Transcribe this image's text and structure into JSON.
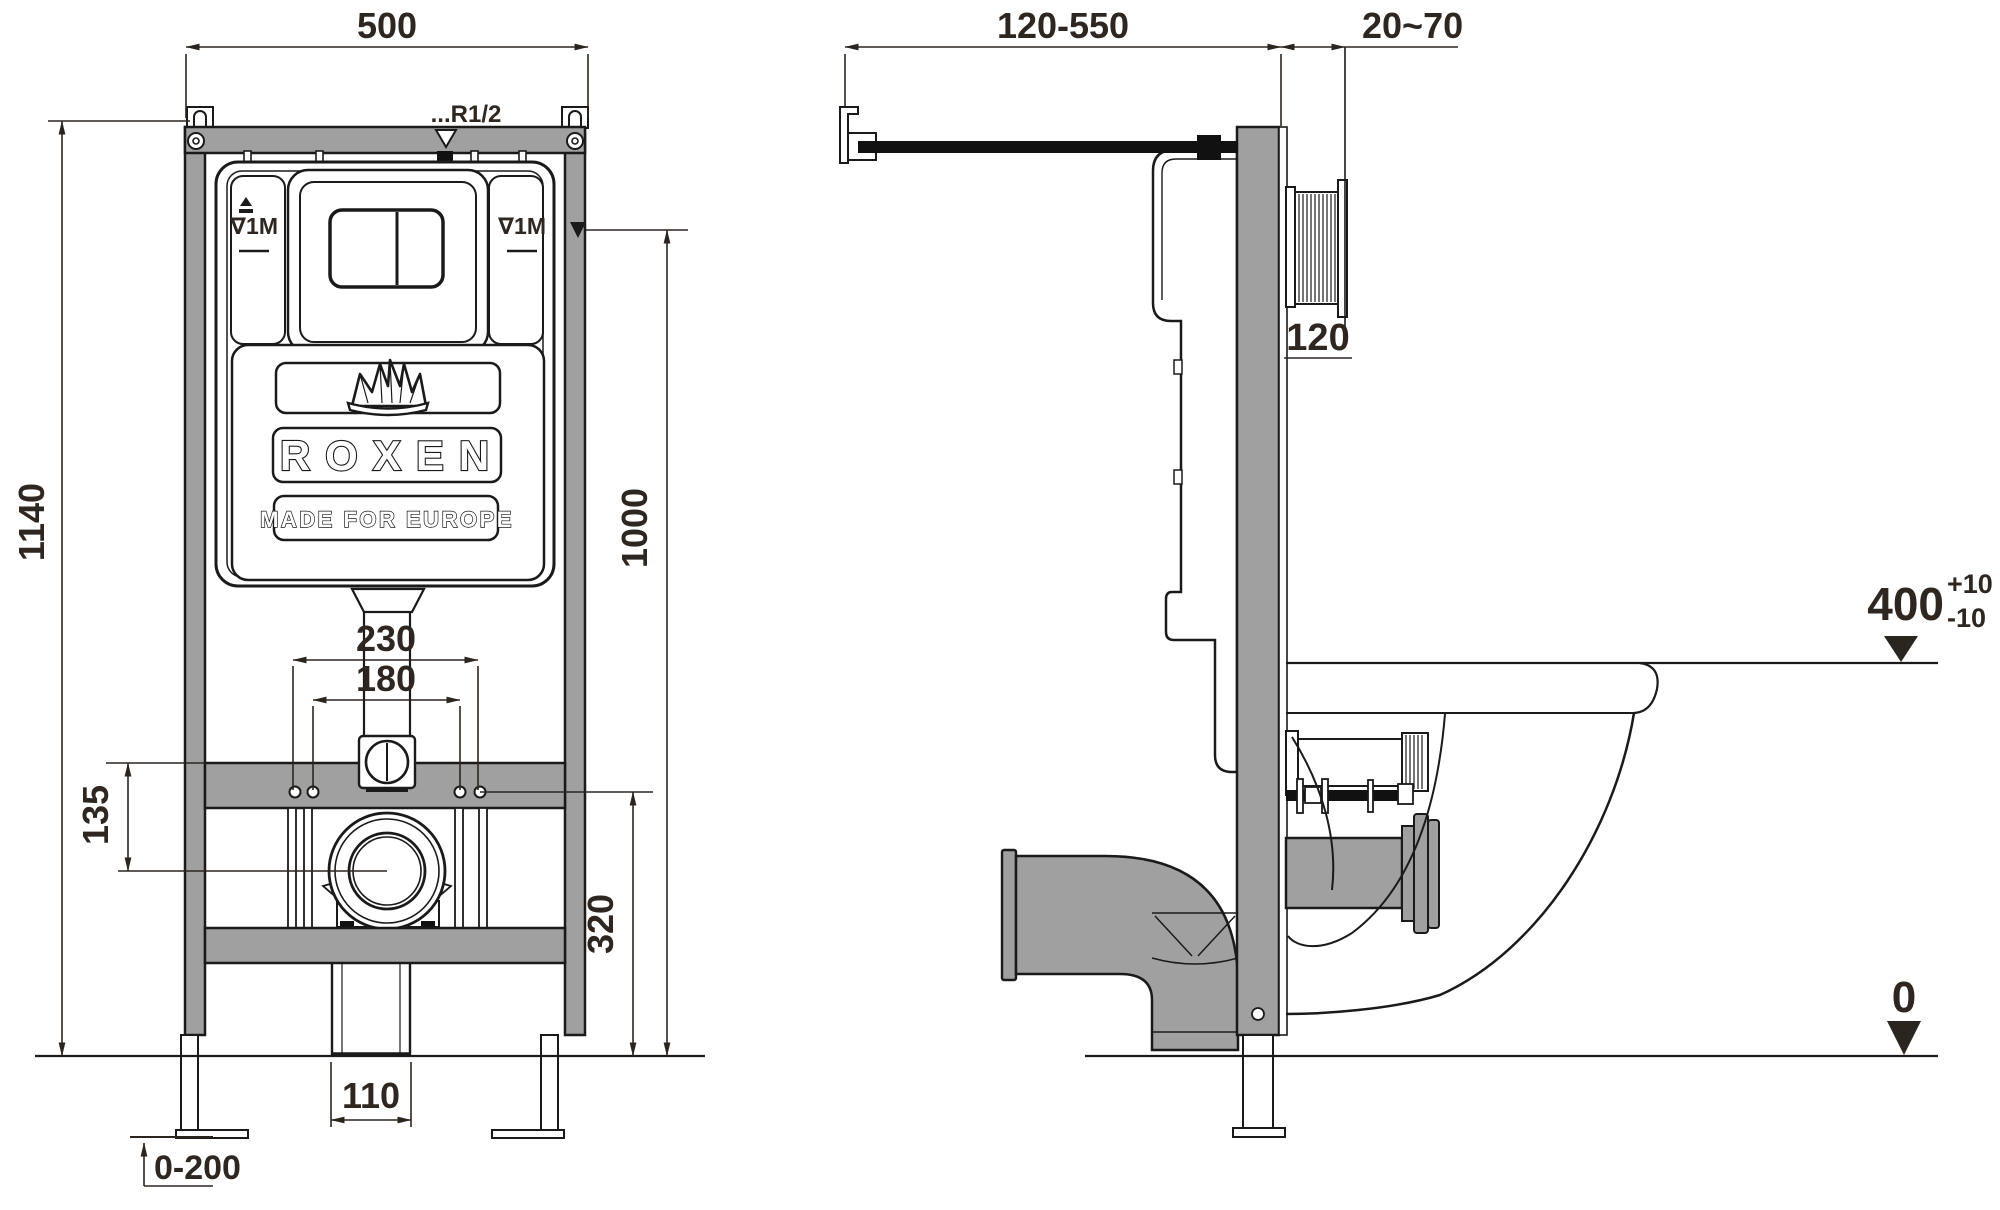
{
  "drawing": {
    "brand": {
      "name": "ROXEN",
      "tagline": "MADE FOR EUROPE",
      "logo_icon": "crown-icon"
    },
    "colors": {
      "metal_gray": "#a0a0a0",
      "line_black": "#1a1a1a",
      "dim_text": "#2e2620"
    },
    "front_view": {
      "dim_width_top": "500",
      "dim_total_height": "1140",
      "dim_flush_pipe_height": "1000",
      "dim_bolt_spacing_outer": "230",
      "dim_bolt_spacing_inner": "180",
      "dim_drain_offset": "135",
      "dim_drain_height": "320",
      "dim_outlet_width": "110",
      "dim_foot_adjust_range": "0-200",
      "label_water_inlet": "...R1/2",
      "label_level_left": "∇1M",
      "label_level_right": "∇1M"
    },
    "side_view": {
      "dim_rod_length": "120-550",
      "dim_wall_finish_range": "20~70",
      "dim_frame_depth": "120",
      "dim_rim_height": "400",
      "dim_rim_tolerance_plus": "+10",
      "dim_rim_tolerance_minus": "-10",
      "dim_floor_level": "0"
    }
  }
}
